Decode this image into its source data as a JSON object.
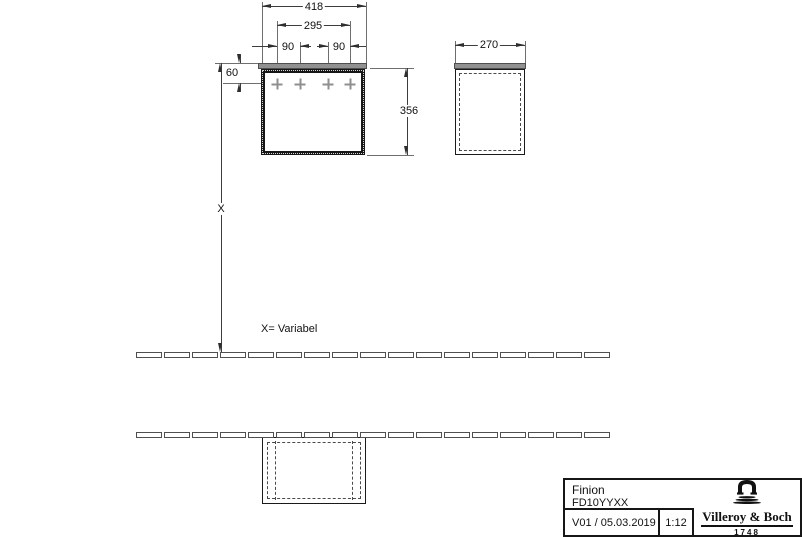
{
  "drawing": {
    "dims": {
      "total_width": "418",
      "hole_span": "295",
      "hole_offset_left": "90",
      "hole_offset_right": "90",
      "top_edge_offset": "60",
      "body_height": "356",
      "depth": "270",
      "floor_distance": "X"
    },
    "notes": {
      "variable": "X= Variabel"
    }
  },
  "title_block": {
    "product_line": "Finion",
    "article_number": "FD10YYXX",
    "version_date": "V01 / 05.03.2019",
    "scale": "1:12",
    "brand": {
      "name": "Villeroy & Boch",
      "since_year": "1748"
    }
  },
  "colors": {
    "line": "#3d3d3d",
    "panel_fill": "#919191",
    "marker": "#8f8f8f",
    "background": "#ffffff"
  }
}
